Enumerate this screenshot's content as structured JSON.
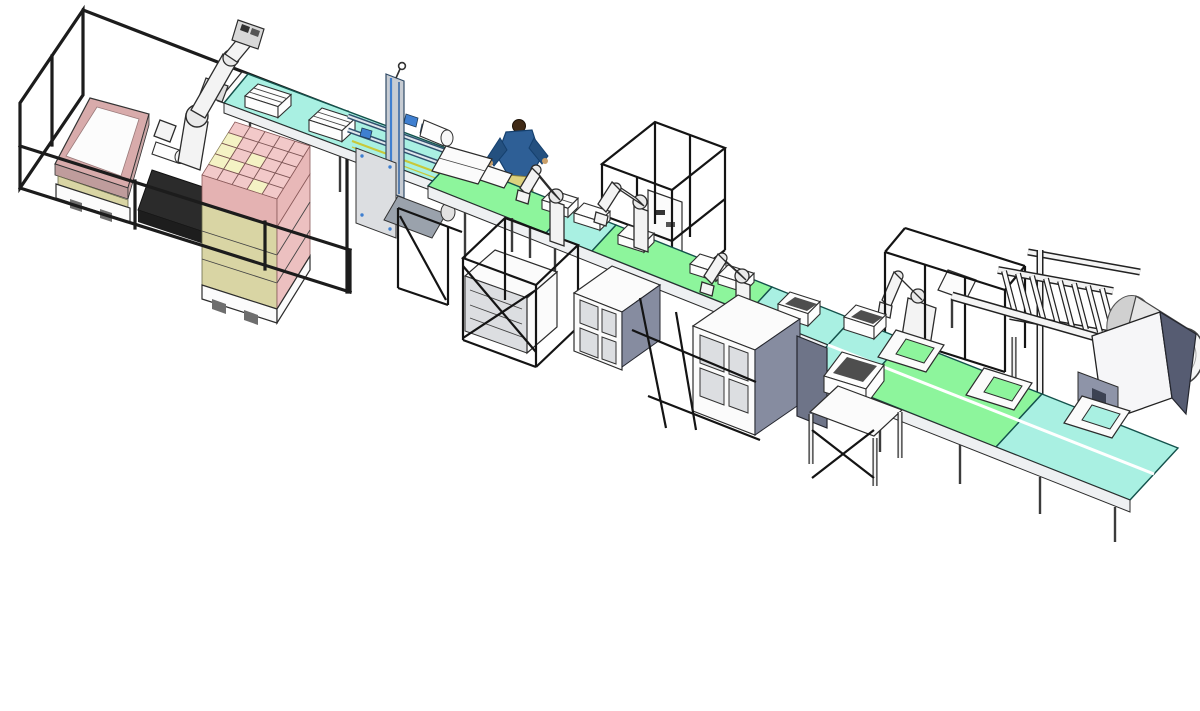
{
  "scene": {
    "label": "3D CAD rendering of an automated packaging and palletizing production line, isometric view on white background"
  },
  "colors": {
    "belt_cyan": "#a9f0e2",
    "belt_green": "#8df59c",
    "belt_edge": "#14524c",
    "box_pink": "#f2c9c9",
    "box_yellow": "#f4f2c4",
    "layer_khaki": "#d9d5a4",
    "tray_pink": "#d8abab",
    "frame_black": "#1c1c1c",
    "robot_white": "#f3f3f3",
    "steel_gray": "#c7ccd3",
    "panel_gray": "#dcdee1",
    "cabinet_slate": "#868ca0",
    "machine_blue": "#3f7fd0",
    "accent_yellow": "#c8c83a",
    "shirt_blue": "#2e5f96",
    "pants_khaki": "#ddd27e",
    "machine_slate": "#565c72",
    "background": "#ffffff"
  },
  "equipment": {
    "fence": "perimeter safety fence of palletizing cell",
    "tray_station": "empty tray on pallet pick station",
    "palletizer": "six-axis palletizing robot",
    "pallet_stack": "pallet stacked with pink and yellow cartons",
    "infeed": "cyan infeed box conveyor",
    "case_packer": "case packing machine with blue frame",
    "operator": "operator figure at conveyor",
    "process_cage": "overhead safety cage at process conveyor",
    "process_conveyor": "green and cyan process conveyor",
    "pick_robots": "pick and place robot arms along conveyor",
    "caged_machine": "caged forming machine below line",
    "cabinets": "electrical equipment cabinets",
    "robot_cell": "fenced robot cell at outfeed",
    "roller_rack": "gravity roller storage rack",
    "film_unit": "film roll wrapping unit",
    "outfeed": "double lane outfeed conveyor",
    "carriers": "tray carriers and open boxes on outfeed belts",
    "table": "packing work table with open box"
  }
}
